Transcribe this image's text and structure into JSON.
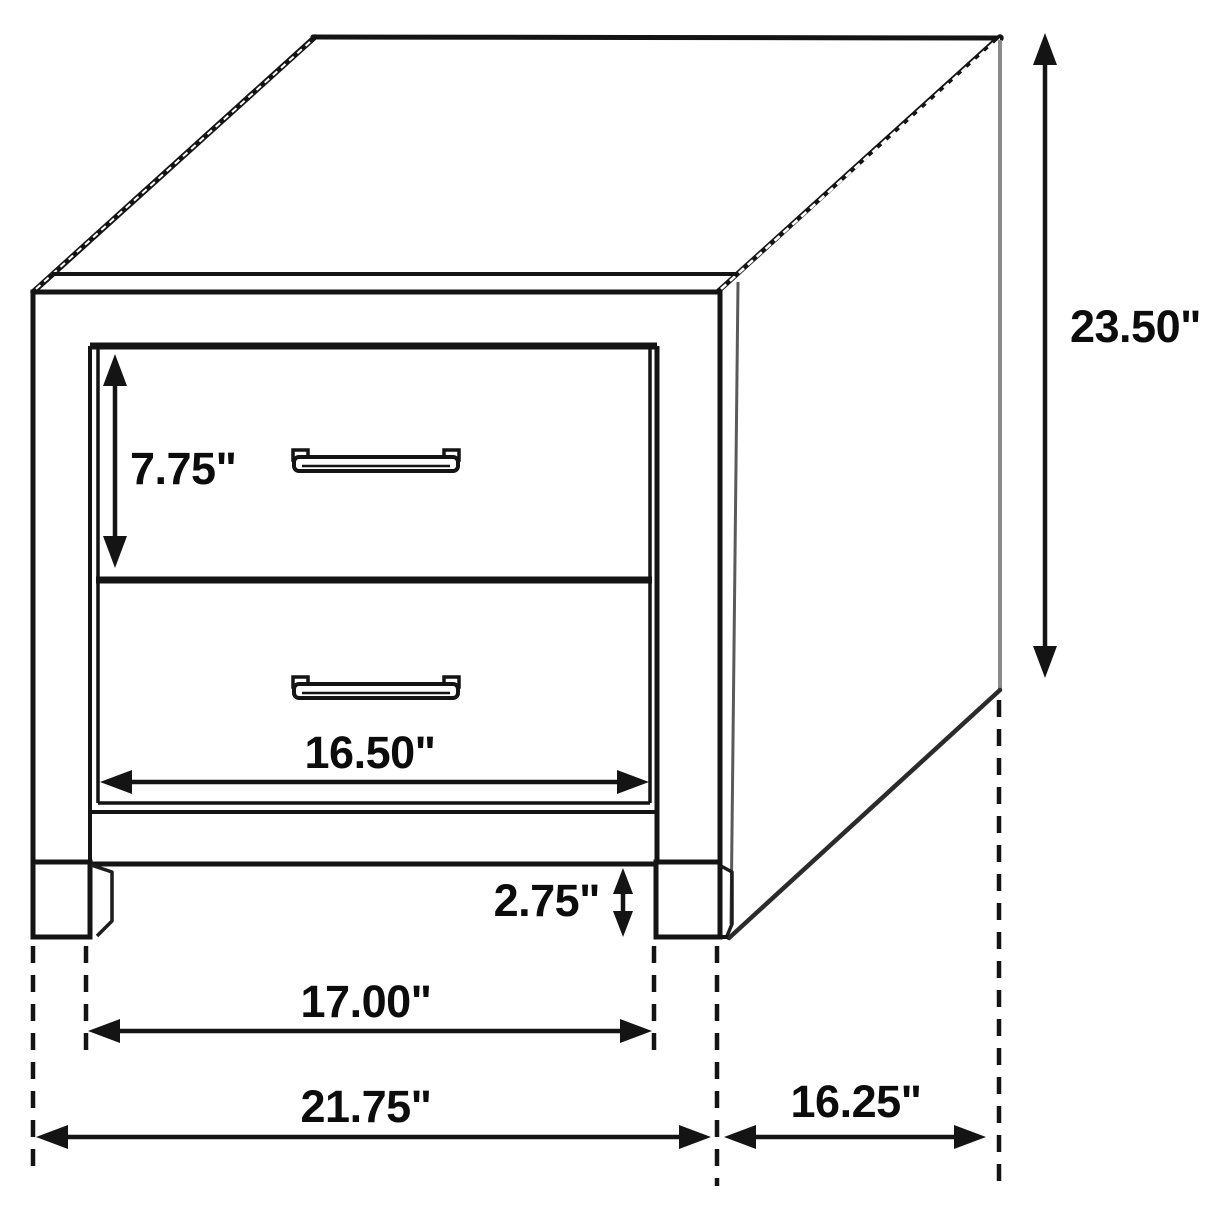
{
  "diagram": {
    "subject": "Two-drawer nightstand line drawing, three-quarter perspective view, with dimension arrows",
    "background_color": "#ffffff",
    "line_color": "#141414",
    "dimensions": {
      "drawer_height": {
        "label": "7.75\""
      },
      "overall_height": {
        "label": "23.50\""
      },
      "drawer_width": {
        "label": "16.50\""
      },
      "leg_height": {
        "label": "2.75\""
      },
      "inner_width": {
        "label": "17.00\""
      },
      "overall_width": {
        "label": "21.75\""
      },
      "overall_depth": {
        "label": "16.25\""
      }
    }
  }
}
